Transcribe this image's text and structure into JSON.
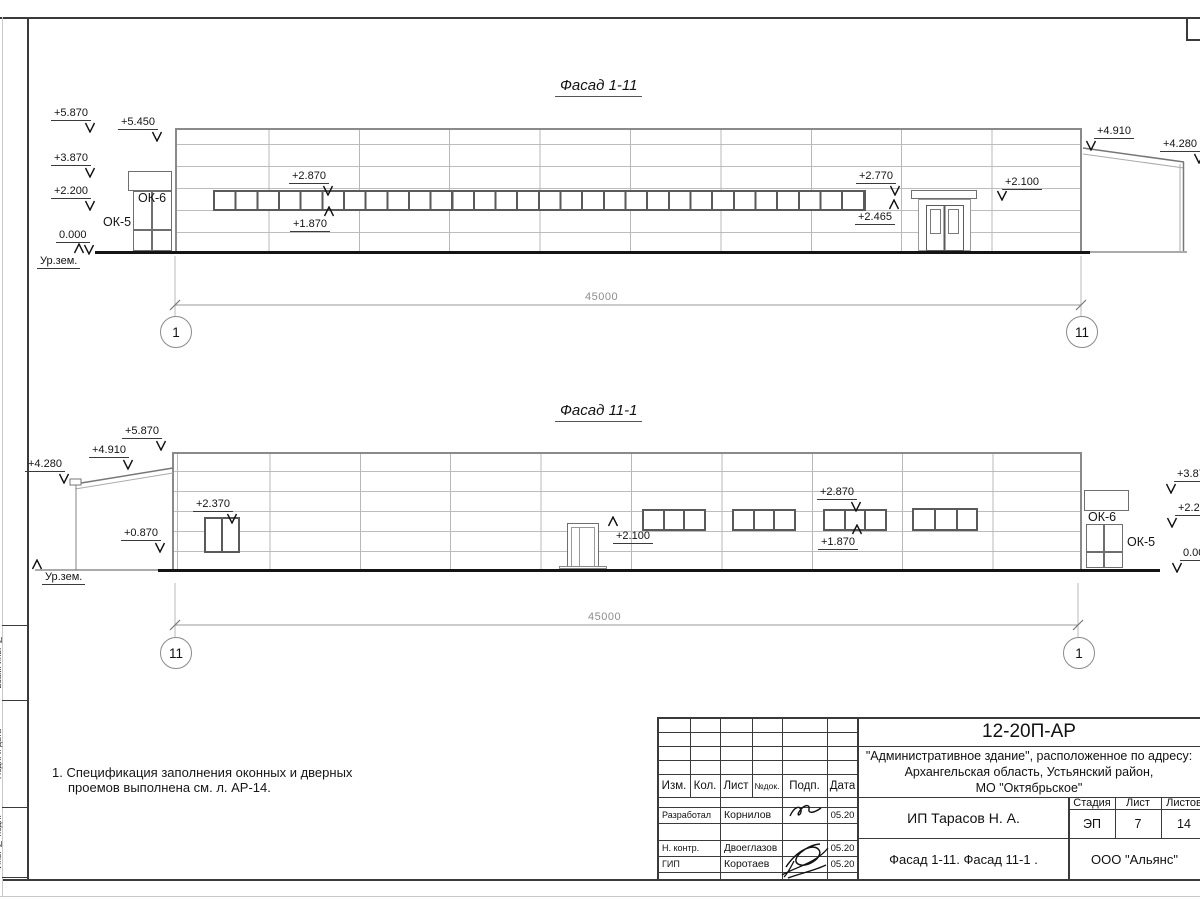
{
  "sheet": {
    "note": {
      "line1": "1. Спецификация заполнения оконных и дверных",
      "line2": "проемов выполнена см. л. АР-14."
    },
    "side_labels": {
      "top": "Взам. инв. №",
      "mid": "Подп. и дата",
      "bottom": "Инв. № подл."
    }
  },
  "facade1": {
    "title": "Фасад 1-11",
    "span": "45000",
    "axis_left": "1",
    "axis_right": "11",
    "marks": {
      "m5870": "+5.870",
      "m5450": "+5.450",
      "m3870": "+3.870",
      "m2200": "+2.200",
      "m0000": "0.000",
      "ground": "Ур.зем.",
      "ok6": "ОК-6",
      "ok5": "ОК-5",
      "m2870": "+2.870",
      "m1870": "+1.870",
      "m2770": "+2.770",
      "m2465": "+2.465",
      "m2100": "+2.100",
      "m4910": "+4.910",
      "m4280": "+4.280"
    }
  },
  "facade2": {
    "title": "Фасад 11-1",
    "span": "45000",
    "axis_left": "11",
    "axis_right": "1",
    "marks": {
      "m5870": "+5.870",
      "m4910": "+4.910",
      "m4280": "+4.280",
      "m2370": "+2.370",
      "m0870": "+0.870",
      "ground": "Ур.зем.",
      "m2100": "+2.100",
      "m2870": "+2.870",
      "m1870": "+1.870",
      "ok6": "ОК-6",
      "ok5": "ОК-5",
      "m3870": "+3.870",
      "m2200": "+2.200",
      "m0000": "0.000"
    }
  },
  "titleblock": {
    "doc_number": "12-20П-АР",
    "address1": "\"Административное здание\", расположенное по адресу:",
    "address2": "Архангельская область, Устьянский район,",
    "address3": "МО \"Октябрьское\"",
    "cols": {
      "izm": "Изм.",
      "kol": "Кол.",
      "list": "Лист",
      "ndok": "№док.",
      "podp": "Подп.",
      "data": "Дата"
    },
    "rows": {
      "developed_label": "Разработал",
      "developed_name": "Корнилов",
      "developed_date": "05.20",
      "ncontrol_label": "Н. контр.",
      "ncontrol_name": "Двоеглазов",
      "ncontrol_date": "05.20",
      "gip_label": "ГИП",
      "gip_name": "Коротаев",
      "gip_date": "05.20"
    },
    "client": "ИП Тарасов Н. А.",
    "drawing_title": "Фасад 1-11. Фасад 11-1 .",
    "stage_label": "Стадия",
    "sheet_label": "Лист",
    "sheets_label": "Листов",
    "stage": "ЭП",
    "sheet_num": "7",
    "sheets_total": "14",
    "company": "ООО \"Альянс\""
  }
}
